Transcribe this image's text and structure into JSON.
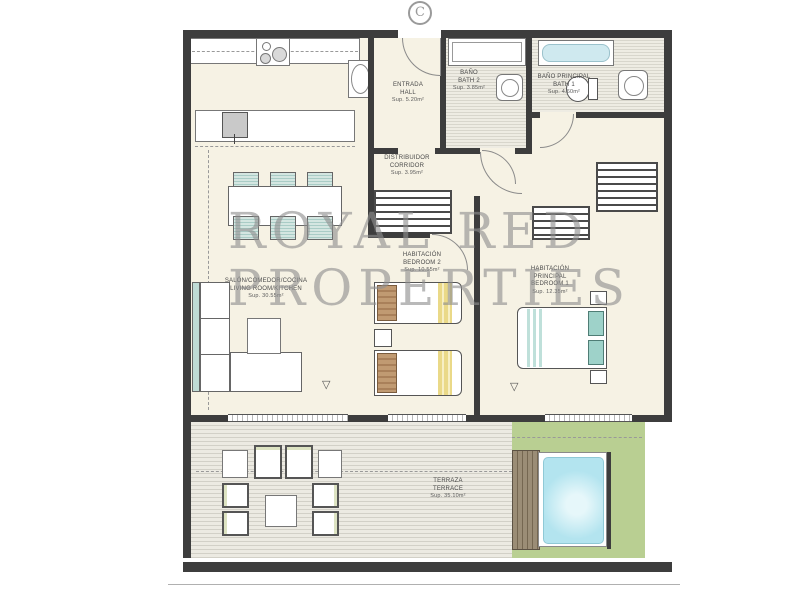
{
  "plan": {
    "compass_marker": "C",
    "watermark": {
      "line1": "ROYAL RED",
      "line2": "PROPERTIES"
    },
    "rooms": {
      "hall": {
        "name_es": "ENTRADA",
        "name_en": "HALL",
        "area": "Sup. 5.20m²"
      },
      "bath2": {
        "name_es": "BAÑO",
        "name_en": "BATH 2",
        "area": "Sup. 3.85m²"
      },
      "bath1": {
        "name_es": "BAÑO PRINCIPAL",
        "name_en": "BATH 1",
        "area": "Sup. 4.60m²"
      },
      "corridor": {
        "name_es": "DISTRIBUIDOR",
        "name_en": "CORRIDOR",
        "area": "Sup. 3.95m²"
      },
      "living": {
        "name_es": "SALÓN/COMEDOR/COCINA",
        "name_en": "LIVING ROOM/KITCHEN",
        "area": "Sup. 30.55m²"
      },
      "bedroom2": {
        "name_es": "HABITACIÓN",
        "name_en": "BEDROOM 2",
        "area": "Sup. 10.55m²"
      },
      "bedroom1": {
        "name_es": "HABITACIÓN PRINCIPAL",
        "name_en": "BEDROOM 1",
        "area": "Sup. 12.35m²"
      },
      "terrace": {
        "name_es": "TERRAZA",
        "name_en": "TERRACE",
        "area": "Sup. 35.10m²"
      }
    },
    "colors": {
      "wall": "#3d3d3d",
      "floor": "#f6f2e4",
      "lawn": "#b9cf92",
      "pool_water": "#b3e4ef",
      "deck_stripe": "#d2d0c7",
      "accent_teal": "#a9ccc6",
      "accent_yellow": "#ead988",
      "watermark_gray": "#8f8f8f"
    }
  }
}
